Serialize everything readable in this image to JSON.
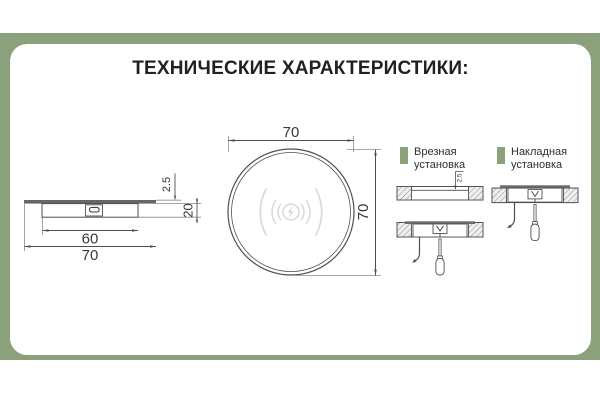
{
  "title": "ТЕХНИЧЕСКИЕ ХАРАКТЕРИСТИКИ:",
  "colors": {
    "accent_green": "#8ba17b",
    "drawing_line": "#4f4f4f",
    "icon_gray": "#d9d9d9"
  },
  "side_view": {
    "dims": {
      "body_width": "60",
      "flange_width": "70",
      "flange_thickness": "2.5",
      "height": "20"
    }
  },
  "top_view": {
    "dims": {
      "width": "70",
      "height": "70"
    },
    "icon": "wireless-charging-icon"
  },
  "installations": [
    {
      "line1": "Врезная",
      "line2": "установка",
      "recess_depth": "2.5"
    },
    {
      "line1": "Накладная",
      "line2": "установка"
    }
  ]
}
